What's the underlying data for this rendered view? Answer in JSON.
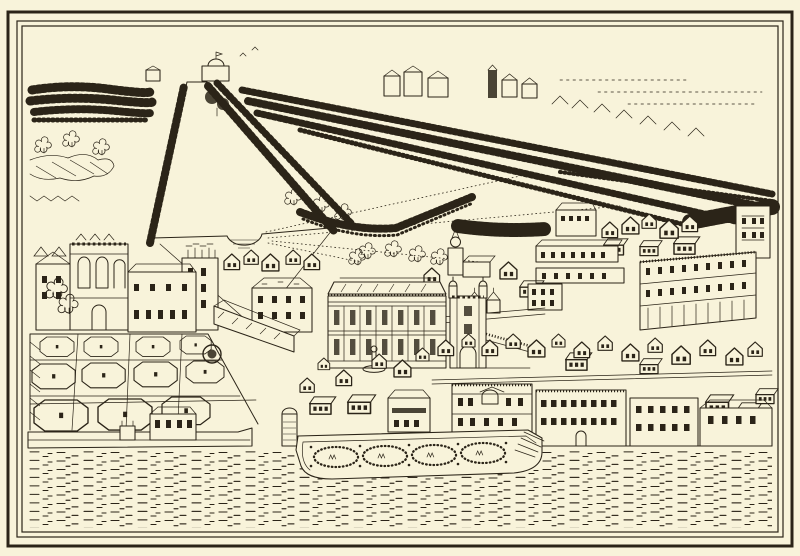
{
  "artwork": {
    "alt": "Antique line engraving: bird's-eye view of Whitehall Palace and the Privy Garden, with the long canal and tree-lined Mall avenues of St James's Park behind, a gabled town to the right, a riverside terrace garden with four oval parterres, and the River Thames in the foreground, framed by a double ruled border on cream paper",
    "medium": "line engraving on cream paper",
    "palette": {
      "paper": "#f8f3da",
      "ink": "#2b2418"
    },
    "regions": {
      "frame": "double ruled border",
      "grove": "woodland grove, upper left",
      "canal": "long canal with rounded basin, flanked by tree rows",
      "mall": "parallel tree avenues of the Mall",
      "horizon": "distant houses and cupola lodge on the skyline",
      "palace": "palace ranges with great gatehouse",
      "banqueting_house": "Banqueting House with two window tiers",
      "holbein_gate": "turreted Holbein Gate",
      "church": "church tower with lantern steeple",
      "town": "dense gabled town houses",
      "privy_garden": "Privy Garden of octagonal grass plots with statues and round fountain pool",
      "terrace": "river terrace garden with four oval shrub parterres and stairs",
      "river": "River Thames with dashed water ripples"
    }
  }
}
